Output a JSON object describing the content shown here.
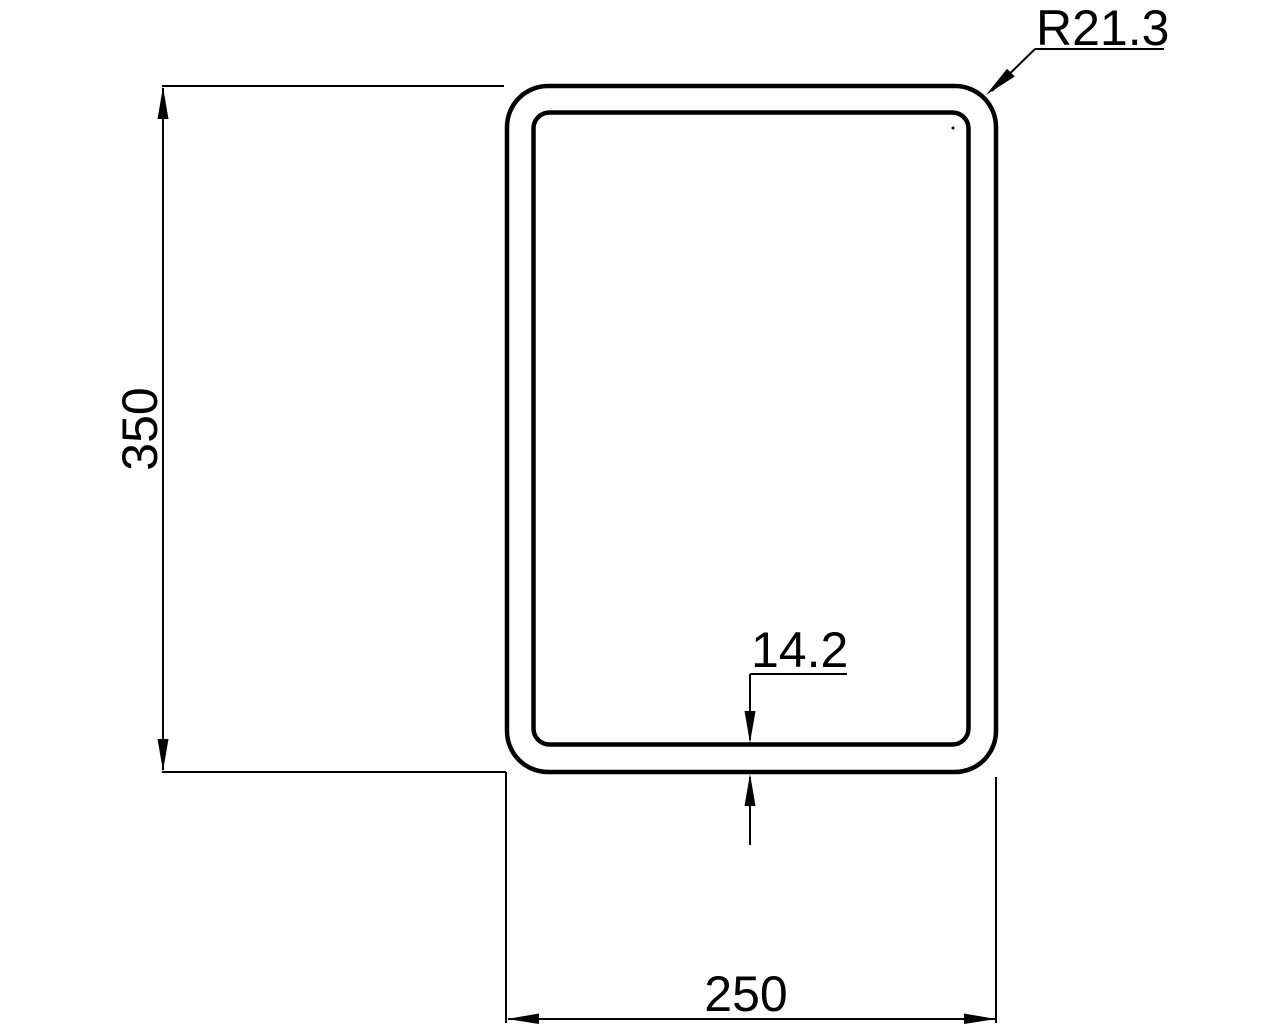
{
  "drawing": {
    "type": "technical-cross-section",
    "labels": {
      "height": "350",
      "width": "250",
      "wall_thickness": "14.2",
      "corner_radius": "R21.3"
    },
    "colors": {
      "line": "#000000",
      "background": "#ffffff"
    }
  }
}
